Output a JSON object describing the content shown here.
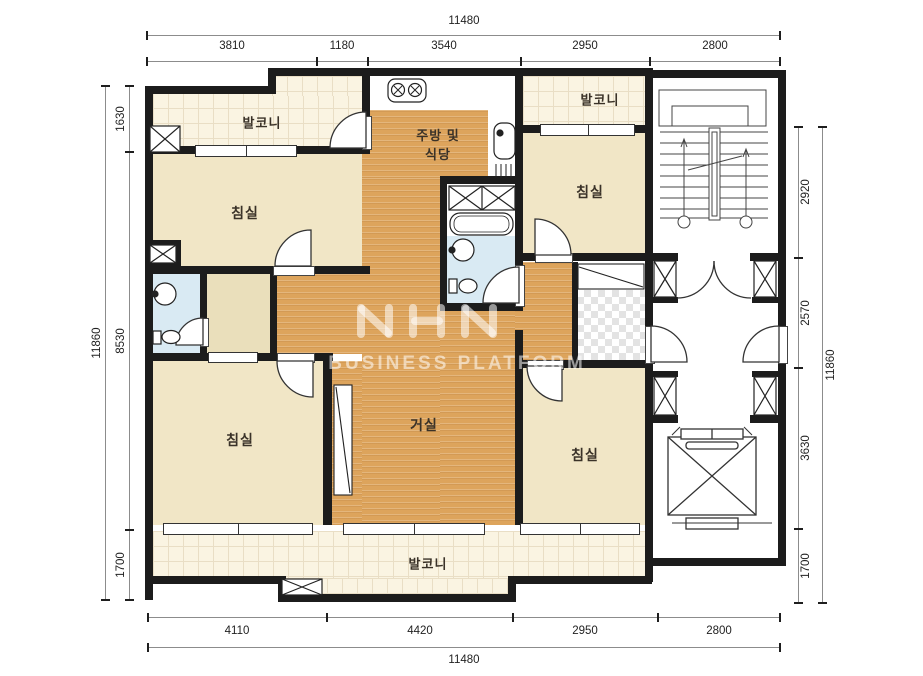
{
  "watermark": {
    "logo": "NHN",
    "subtitle": "BUSINESS PLATFORM"
  },
  "rooms": {
    "balcony_top_left": "발코니",
    "balcony_top_right": "발코니",
    "balcony_bottom": "발코니",
    "bedroom_top_left": "침실",
    "bedroom_top_right": "침실",
    "bedroom_bottom_left": "침실",
    "bedroom_bottom_right": "침실",
    "living_room": "거실",
    "kitchen_line1": "주방 및",
    "kitchen_line2": "식당"
  },
  "dims": {
    "top": {
      "total": "11480",
      "segments": [
        "3810",
        "1180",
        "3540",
        "2950",
        "2800"
      ]
    },
    "bottom": {
      "total": "11480",
      "segments": [
        "4110",
        "4420",
        "2950",
        "2800"
      ]
    },
    "left": {
      "total": "11860",
      "segments": [
        "1630",
        "8530",
        "1700"
      ]
    },
    "right": {
      "total": "11860",
      "segments": [
        "2920",
        "2570",
        "3630",
        "1700"
      ]
    }
  },
  "colors": {
    "wall": "#1c1c1c",
    "wood_floor": "#dda45c",
    "bedroom_floor": "#f1e6c6",
    "balcony_floor": "#faf4e2",
    "bath_floor": "#d9eaf3",
    "dim_text": "#222222",
    "watermark": "rgba(255,255,255,0.55)"
  }
}
